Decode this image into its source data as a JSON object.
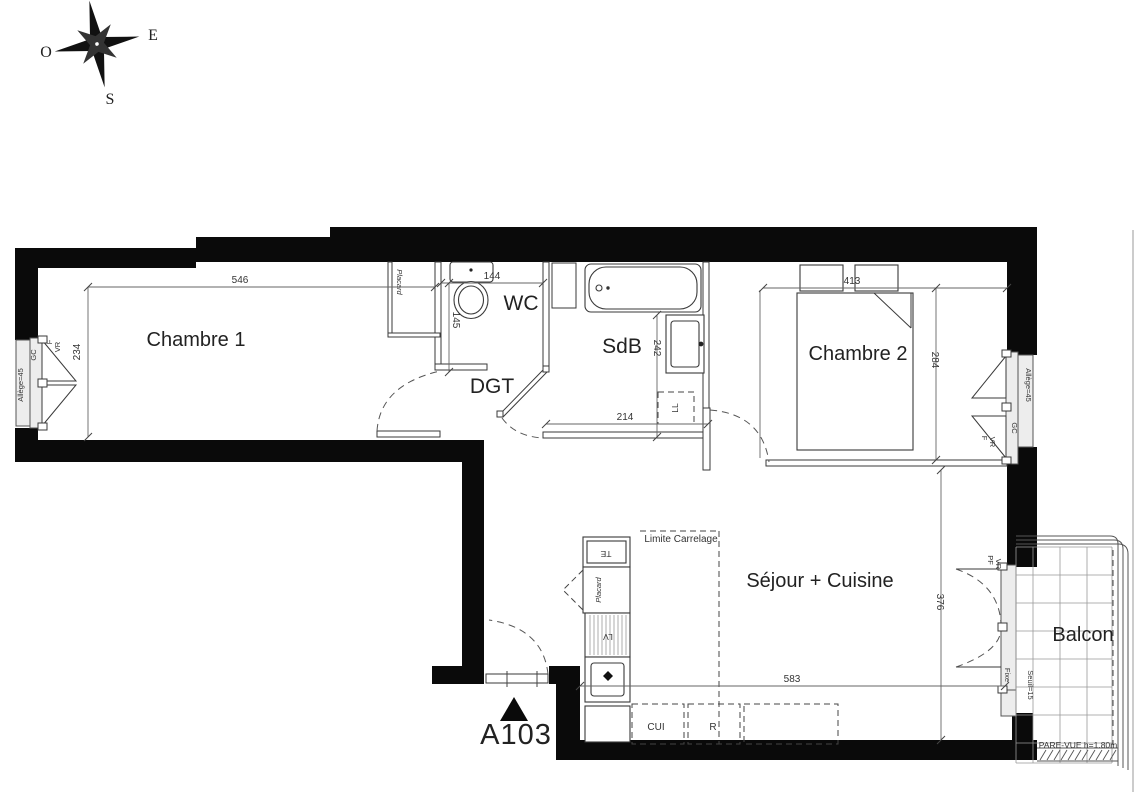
{
  "compass": {
    "east": "E",
    "west": "O",
    "south": "S"
  },
  "apartment": {
    "number": "A103"
  },
  "rooms": {
    "chambre1": {
      "label": "Chambre 1"
    },
    "wc": {
      "label": "WC"
    },
    "dgt": {
      "label": "DGT"
    },
    "sdb": {
      "label": "SdB"
    },
    "chambre2": {
      "label": "Chambre 2"
    },
    "sejour": {
      "label": "Séjour + Cuisine"
    },
    "balcon": {
      "label": "Balcon"
    }
  },
  "dimensions_cm": {
    "chambre1_width": "546",
    "chambre1_depth": "234",
    "wc_width": "144",
    "wc_depth": "145",
    "sdb_depth": "242",
    "sdb_width": "214",
    "chambre2_width": "413",
    "chambre2_depth": "284",
    "sejour_width": "583",
    "sejour_depth": "376"
  },
  "annotations": {
    "placard_chambre1": "Placard",
    "placard_entree": "Placard",
    "te": "TE",
    "lv": "LV",
    "ll": "LL",
    "cui": "CUI",
    "refrigerateur": "R",
    "limite_carrelage": "Limite Carrelage",
    "pare_vue": "PARE-VUE h=1.80m",
    "allege_gauche": "Allège=45",
    "allege_droite": "Allège=45",
    "gc_gauche": "GC",
    "gc_droite": "GC",
    "f_gauche": "F",
    "vr_gauche": "VR",
    "f_droite": "F",
    "vr_droite": "VR",
    "pf_sejour": "PF",
    "vr_sejour": "VR",
    "fixe": "Fixe",
    "seuil": "Seuil=15"
  }
}
